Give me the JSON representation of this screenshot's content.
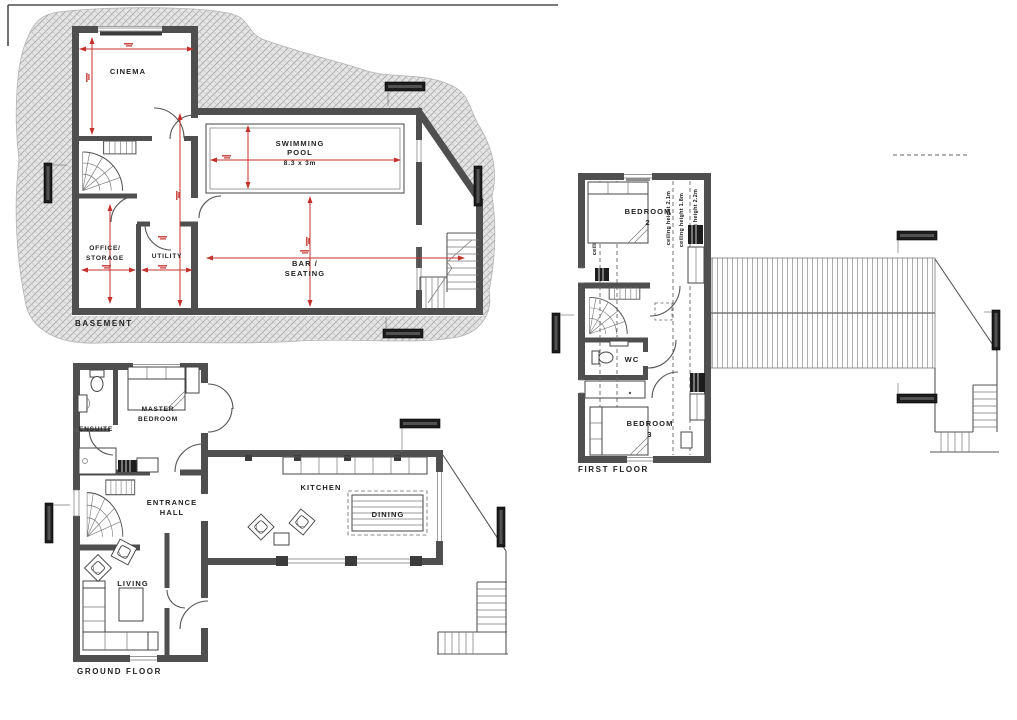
{
  "drawing": {
    "type": "architectural floor plans",
    "floors": {
      "basement": {
        "title": "BASEMENT",
        "rooms": {
          "cinema": "CINEMA",
          "pool_line1": "SWIMMING",
          "pool_line2": "POOL",
          "pool_dims": "8.3 x 3m",
          "office_line1": "OFFICE/",
          "office_line2": "STORAGE",
          "utility": "UTILITY",
          "bar_line1": "BAR /",
          "bar_line2": "SEATING"
        }
      },
      "ground": {
        "title": "GROUND FLOOR",
        "rooms": {
          "master_line1": "MASTER",
          "master_line2": "BEDROOM",
          "ensuite": "ENSUITE",
          "hall_line1": "ENTRANCE",
          "hall_line2": "HALL",
          "kitchen": "KITCHEN",
          "dining": "DINING",
          "living": "LIVING"
        }
      },
      "first": {
        "title": "FIRST FLOOR",
        "rooms": {
          "bedroom2_label": "BEDROOM",
          "bedroom2_num": "2",
          "wc": "WC",
          "bedroom3_label": "BEDROOM",
          "bedroom3_num": "3"
        },
        "annotations": {
          "ceil1": "ceiling height 1.1m",
          "ceil2": "ceiling height 2.1m",
          "ceil3": "ceiling height 1.8m",
          "ceil4": "ceiling height 2.2m"
        }
      }
    },
    "colors": {
      "wall": "#4f4f4f",
      "dimension_red": "#c4312c",
      "earth_hatch": "#a8a8a8",
      "text": "#1f1f1f"
    }
  }
}
